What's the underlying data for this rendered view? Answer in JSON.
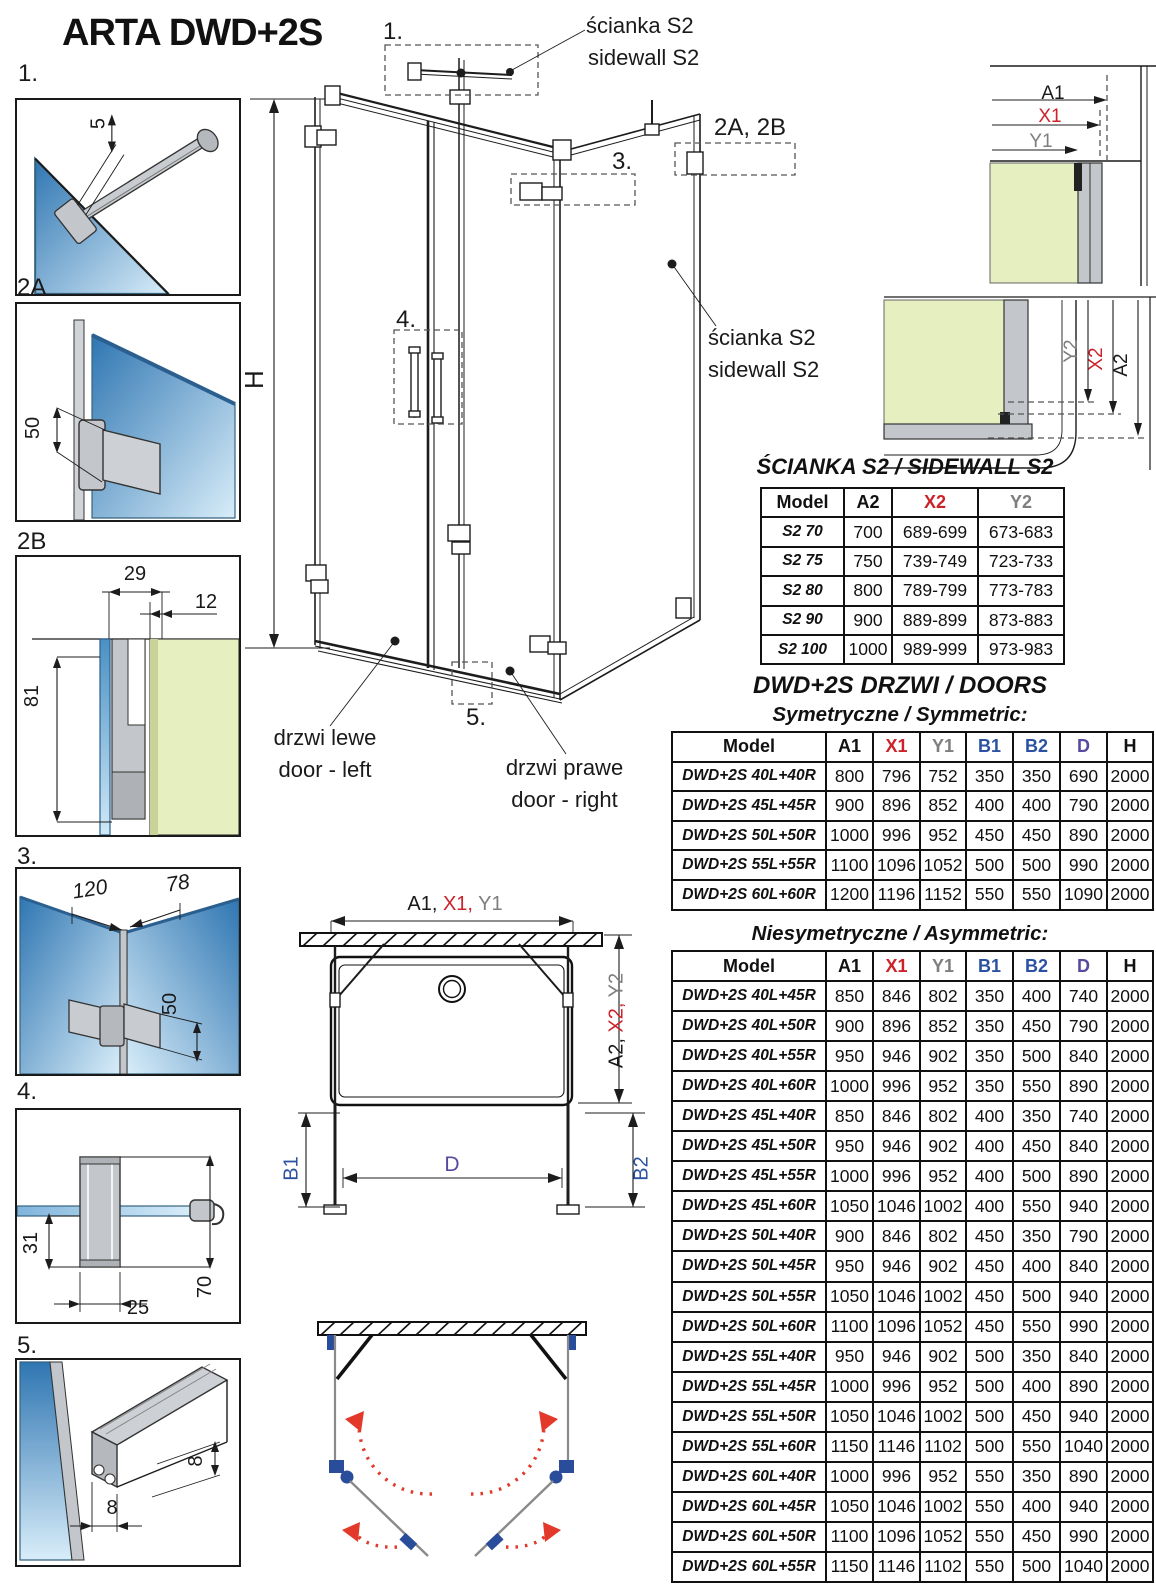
{
  "page": {
    "title": "ARTA DWD+2S"
  },
  "colors": {
    "red": "#cc2229",
    "gray": "#7e7e7e",
    "blue": "#2b52a2",
    "purple": "#584a9e",
    "glass_blue": "#3279b6",
    "glass_green": "#e6efbf",
    "arrow_red": "#e2392b",
    "hinge_blue": "#2a4d9b"
  },
  "details": {
    "d1": {
      "label": "1.",
      "dim5": "5"
    },
    "d2a": {
      "label": "2A",
      "dim50": "50"
    },
    "d2b": {
      "label": "2B",
      "dim29": "29",
      "dim12": "12",
      "dim81": "81"
    },
    "d3": {
      "label": "3.",
      "dim120": "120",
      "dim78": "78",
      "dim50": "50"
    },
    "d4": {
      "label": "4.",
      "dim31": "31",
      "dim25": "25",
      "dim70": "70"
    },
    "d5": {
      "label": "5.",
      "dim8a": "8",
      "dim8b": "8"
    }
  },
  "main": {
    "callout1": "1.",
    "callout2ab": "2A, 2B",
    "callout3": "3.",
    "callout4": "4.",
    "callout5": "5.",
    "height": "H",
    "sidewall_top1": "ścianka S2",
    "sidewall_top2": "sidewall S2",
    "sidewall_right1": "ścianka S2",
    "sidewall_right2": "sidewall S2",
    "door_left1": "drzwi lewe",
    "door_left2": "door - left",
    "door_right1": "drzwi prawe",
    "door_right2": "door - right"
  },
  "corner_top": {
    "a1": "A1",
    "x1": "X1",
    "y1": "Y1"
  },
  "corner_side": {
    "y2": "Y2",
    "x2": "X2",
    "a2": "A2"
  },
  "plan": {
    "top_black": "A1, ",
    "top_red": "X1,",
    "top_gray": " Y1",
    "side_black": "A2, ",
    "side_red": "X2,",
    "side_gray": " Y2",
    "b1": "B1",
    "d": "D",
    "b2": "B2"
  },
  "s2": {
    "title": "ŚCIANKA S2 / SIDEWALL S2",
    "headers": [
      {
        "t": "Model",
        "c": "#111111"
      },
      {
        "t": "A2",
        "c": "#111111"
      },
      {
        "t": "X2",
        "c": "#cc2229"
      },
      {
        "t": "Y2",
        "c": "#7e7e7e"
      }
    ],
    "rows": [
      [
        "S2 70",
        "700",
        "689-699",
        "673-683"
      ],
      [
        "S2 75",
        "750",
        "739-749",
        "723-733"
      ],
      [
        "S2 80",
        "800",
        "789-799",
        "773-783"
      ],
      [
        "S2 90",
        "900",
        "889-899",
        "873-883"
      ],
      [
        "S2 100",
        "1000",
        "989-999",
        "973-983"
      ]
    ]
  },
  "doors": {
    "title": "DWD+2S DRZWI / DOORS",
    "sym_title": "Symetryczne / Symmetric:",
    "asym_title": "Niesymetryczne / Asymmetric:",
    "headers": [
      {
        "t": "Model",
        "c": "#111111"
      },
      {
        "t": "A1",
        "c": "#111111"
      },
      {
        "t": "X1",
        "c": "#cc2229"
      },
      {
        "t": "Y1",
        "c": "#7e7e7e"
      },
      {
        "t": "B1",
        "c": "#2b52a2"
      },
      {
        "t": "B2",
        "c": "#2b52a2"
      },
      {
        "t": "D",
        "c": "#584a9e"
      },
      {
        "t": "H",
        "c": "#111111"
      }
    ],
    "sym_rows": [
      [
        "DWD+2S 40L+40R",
        "800",
        "796",
        "752",
        "350",
        "350",
        "690",
        "2000"
      ],
      [
        "DWD+2S 45L+45R",
        "900",
        "896",
        "852",
        "400",
        "400",
        "790",
        "2000"
      ],
      [
        "DWD+2S 50L+50R",
        "1000",
        "996",
        "952",
        "450",
        "450",
        "890",
        "2000"
      ],
      [
        "DWD+2S 55L+55R",
        "1100",
        "1096",
        "1052",
        "500",
        "500",
        "990",
        "2000"
      ],
      [
        "DWD+2S 60L+60R",
        "1200",
        "1196",
        "1152",
        "550",
        "550",
        "1090",
        "2000"
      ]
    ],
    "asym_rows": [
      [
        "DWD+2S 40L+45R",
        "850",
        "846",
        "802",
        "350",
        "400",
        "740",
        "2000"
      ],
      [
        "DWD+2S 40L+50R",
        "900",
        "896",
        "852",
        "350",
        "450",
        "790",
        "2000"
      ],
      [
        "DWD+2S 40L+55R",
        "950",
        "946",
        "902",
        "350",
        "500",
        "840",
        "2000"
      ],
      [
        "DWD+2S 40L+60R",
        "1000",
        "996",
        "952",
        "350",
        "550",
        "890",
        "2000"
      ],
      [
        "DWD+2S 45L+40R",
        "850",
        "846",
        "802",
        "400",
        "350",
        "740",
        "2000"
      ],
      [
        "DWD+2S 45L+50R",
        "950",
        "946",
        "902",
        "400",
        "450",
        "840",
        "2000"
      ],
      [
        "DWD+2S 45L+55R",
        "1000",
        "996",
        "952",
        "400",
        "500",
        "890",
        "2000"
      ],
      [
        "DWD+2S 45L+60R",
        "1050",
        "1046",
        "1002",
        "400",
        "550",
        "940",
        "2000"
      ],
      [
        "DWD+2S 50L+40R",
        "900",
        "846",
        "802",
        "450",
        "350",
        "790",
        "2000"
      ],
      [
        "DWD+2S 50L+45R",
        "950",
        "946",
        "902",
        "450",
        "400",
        "840",
        "2000"
      ],
      [
        "DWD+2S 50L+55R",
        "1050",
        "1046",
        "1002",
        "450",
        "500",
        "940",
        "2000"
      ],
      [
        "DWD+2S 50L+60R",
        "1100",
        "1096",
        "1052",
        "450",
        "550",
        "990",
        "2000"
      ],
      [
        "DWD+2S 55L+40R",
        "950",
        "946",
        "902",
        "500",
        "350",
        "840",
        "2000"
      ],
      [
        "DWD+2S 55L+45R",
        "1000",
        "996",
        "952",
        "500",
        "400",
        "890",
        "2000"
      ],
      [
        "DWD+2S 55L+50R",
        "1050",
        "1046",
        "1002",
        "500",
        "450",
        "940",
        "2000"
      ],
      [
        "DWD+2S 55L+60R",
        "1150",
        "1146",
        "1102",
        "500",
        "550",
        "1040",
        "2000"
      ],
      [
        "DWD+2S 60L+40R",
        "1000",
        "996",
        "952",
        "550",
        "350",
        "890",
        "2000"
      ],
      [
        "DWD+2S 60L+45R",
        "1050",
        "1046",
        "1002",
        "550",
        "400",
        "940",
        "2000"
      ],
      [
        "DWD+2S 60L+50R",
        "1100",
        "1096",
        "1052",
        "550",
        "450",
        "990",
        "2000"
      ],
      [
        "DWD+2S 60L+55R",
        "1150",
        "1146",
        "1102",
        "550",
        "500",
        "1040",
        "2000"
      ]
    ]
  }
}
